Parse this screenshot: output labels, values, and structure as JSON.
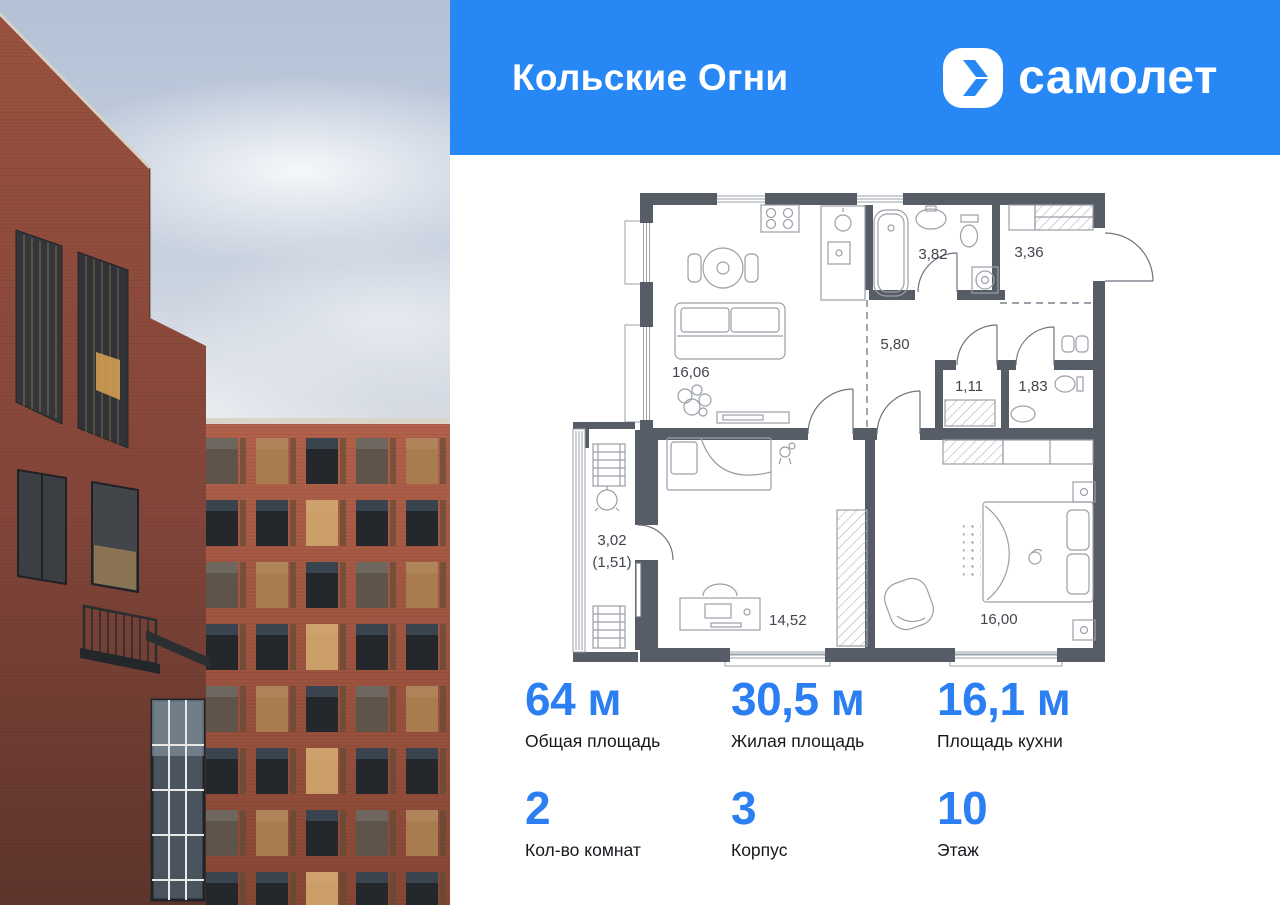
{
  "header": {
    "project_title": "Кольские Огни",
    "brand_name": "самолет"
  },
  "floor_plan": {
    "room_labels": {
      "living_kitchen": "16,06",
      "bathroom": "3,82",
      "entrance_hall": "3,36",
      "corridor": "5,80",
      "wardrobe": "1,11",
      "wc": "1,83",
      "balcony_full": "3,02",
      "balcony_reduced": "(1,51)",
      "children_room": "14,52",
      "bedroom": "16,00"
    }
  },
  "stats": {
    "items": [
      {
        "value": "64 м",
        "label": "Общая площадь"
      },
      {
        "value": "30,5 м",
        "label": "Жилая площадь"
      },
      {
        "value": "16,1 м",
        "label": "Площадь кухни"
      },
      {
        "value": "2",
        "label": "Кол-во комнат"
      },
      {
        "value": "3",
        "label": "Корпус"
      },
      {
        "value": "10",
        "label": "Этаж"
      }
    ]
  },
  "theme": {
    "brand_blue": "#2787F5",
    "stat_number_blue": "#2B7FF2",
    "plan_wall_color": "#575D66",
    "photo_sky_top": "#B3C1D6",
    "brick_foreground": "#8A4A3B",
    "brick_background": "#A85944"
  }
}
